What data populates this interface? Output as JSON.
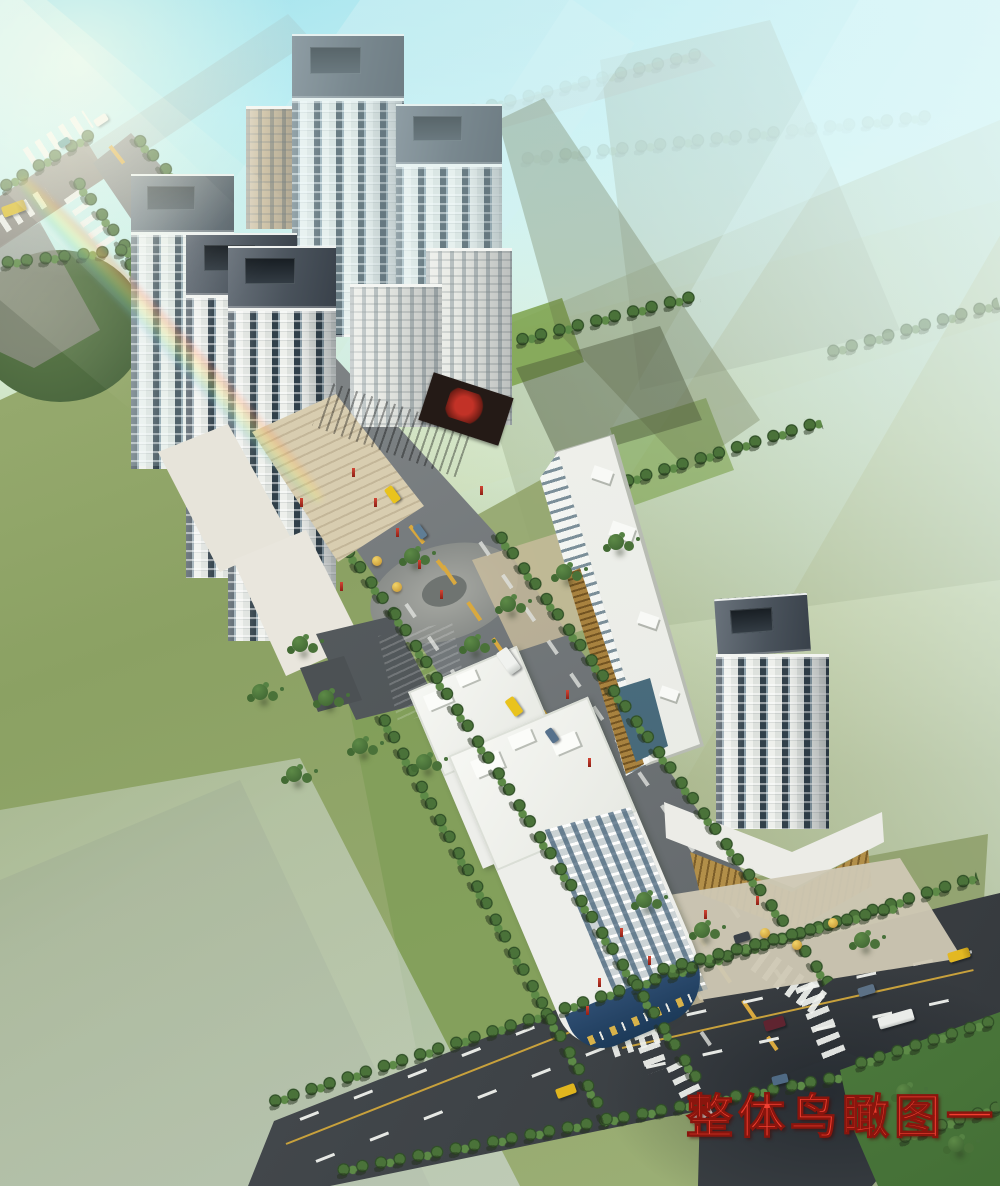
{
  "caption": {
    "text": "整体鸟瞰图一",
    "color": "#f23f31",
    "outline_color": "#8a150d"
  },
  "scene_palette": {
    "sky_cyan": "#a9e7ef",
    "haze_white": "#e6f7f4",
    "land_olive": "#9aa876",
    "land_sage": "#c9d4a3",
    "lawn_green": "#7f9d58",
    "lawn_dark_corner": "#3f6a33",
    "pond_green": "#55714a",
    "road_light_gray": "#8a8d89",
    "road_dark_gray": "#3f4347",
    "tree_green": "#4a7239",
    "tower_wall_white": "#eef0ec",
    "tower_glass_slate": "#31404a",
    "tower_crown_gray": "#49525b",
    "retail_gold": "#b5934c",
    "podium_maroon": "#5c3b30",
    "storefront_blue": "#2e4d71",
    "taxi_yellow": "#e9c31d",
    "lane_marking_yellow": "#d9a93f",
    "lane_marking_white": "#eceeea"
  },
  "scene_inventory": {
    "residential_towers_left_cluster": 5,
    "low_midrise_blocks_left_cluster": 3,
    "office_slab_center": 1,
    "highrise_tower_right_with_podium": 1,
    "midrise_buildings_south": 2,
    "traditional_roof_pavilion": 1,
    "roundabout_plaza": 1,
    "pond": 1,
    "road_intersections": 2,
    "sun_flare_rainbow_top_left": true,
    "vehicles": [
      "yellow-bus",
      "white-van",
      "teal-car",
      "yellow-taxi",
      "blue-car",
      "white-truck",
      "yellow-taxi",
      "blue-car",
      "dark-car",
      "yellow-taxi",
      "blue-sedan",
      "white-bus",
      "dark-red-van",
      "blue-car",
      "yellow-taxi"
    ]
  }
}
